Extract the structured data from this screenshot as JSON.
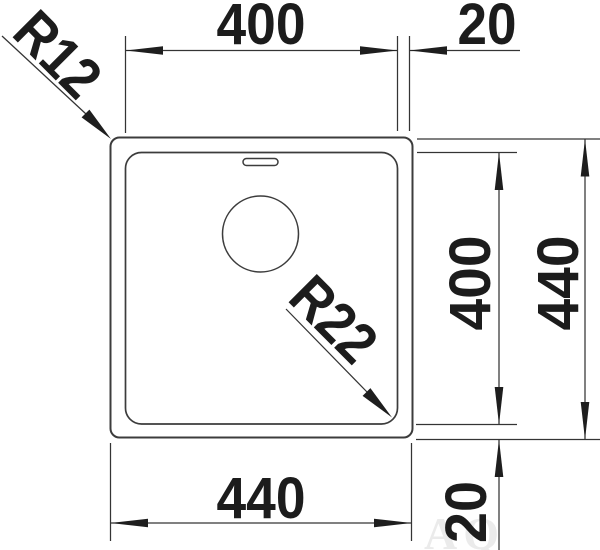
{
  "drawing": {
    "labels": {
      "top_width": "400",
      "top_edge_offset": "20",
      "bowl_height": "400",
      "overall_height": "440",
      "overall_width": "440",
      "bottom_edge_offset": "20",
      "outer_corner_radius": "R12",
      "bowl_corner_radius": "R22"
    },
    "colors": {
      "line": "#3c3c3c",
      "text": "#1c1c1c",
      "background": "#ffffff",
      "watermark": "#ebebeb"
    },
    "watermark": "AQ"
  }
}
